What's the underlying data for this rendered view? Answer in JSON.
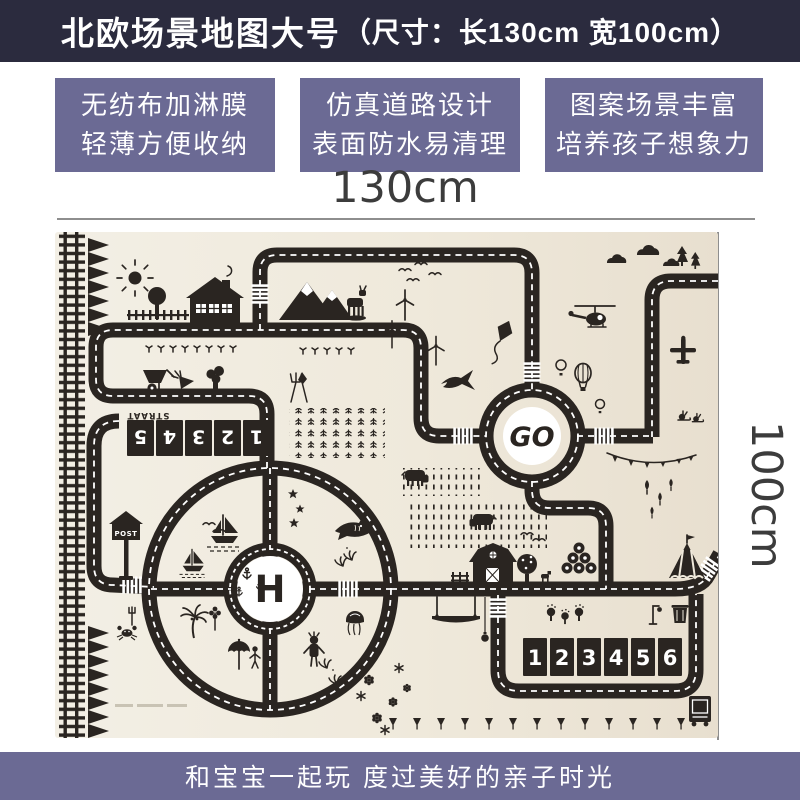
{
  "header": {
    "title_main": "北欧场景地图大号",
    "title_size": "（尺寸：长130cm  宽100cm）",
    "bg_color": "#2b2b3e",
    "text_color": "#ffffff"
  },
  "features": [
    {
      "line1": "无纺布加淋膜",
      "line2": "轻薄方便收纳"
    },
    {
      "line1": "仿真道路设计",
      "line2": "表面防水易清理"
    },
    {
      "line1": "图案场景丰富",
      "line2": "培养孩子想象力"
    }
  ],
  "size_callout": {
    "width_label": "130cm",
    "height_label": "100cm",
    "line_color": "#8e8e8e",
    "text_color": "#3c3c3c"
  },
  "mat": {
    "go_label": "GO",
    "helipad_label": "H",
    "street_label": "STRAAT",
    "post_label": "POST",
    "parking_row_top": [
      "1",
      "2",
      "3",
      "4",
      "5"
    ],
    "parking_row_bottom": [
      "1",
      "2",
      "3",
      "4",
      "5",
      "6"
    ],
    "background": "#f1ecdf",
    "road_color": "#2a2521"
  },
  "footer": {
    "caption": "和宝宝一起玩  度过美好的亲子时光",
    "bg_color": "#6b6a94",
    "text_color": "#ffffff"
  },
  "colors": {
    "accent_purple": "#6b6a94",
    "banner_navy": "#2b2b3e",
    "mat_cream": "#f1ecdf"
  }
}
